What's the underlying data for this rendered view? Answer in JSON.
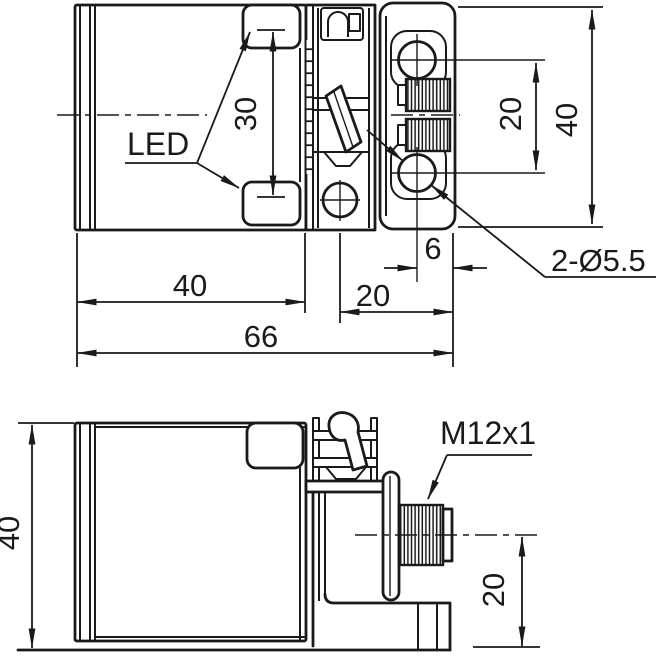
{
  "colors": {
    "ink": "#1a1a1a",
    "background": "#ffffff"
  },
  "top_view": {
    "led_label": "LED",
    "dim_led_window_spacing": "30",
    "dim_hole_spacing": "20",
    "dim_bracket_height": "40",
    "dim_hole_to_edge": "6",
    "hole_callout": "2-Ø5.5",
    "dim_body_length": "40",
    "dim_bracket_length": "20",
    "dim_overall_length": "66"
  },
  "side_view": {
    "dim_body_height": "40",
    "connector_callout": "M12x1",
    "dim_connector_axis_height": "20"
  }
}
